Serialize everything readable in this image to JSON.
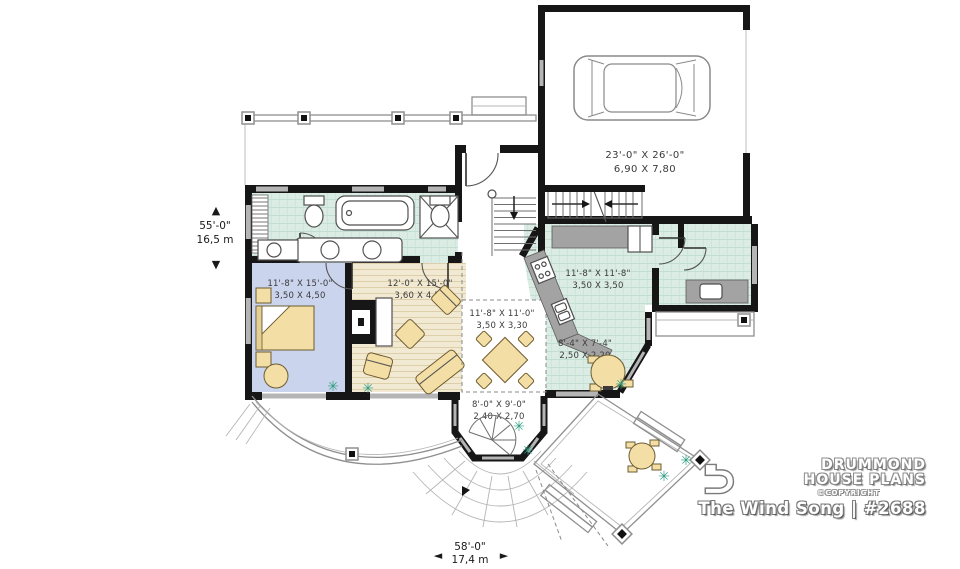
{
  "plan": {
    "title": "The Wind Song | #2688",
    "brand": {
      "line1": "DRUMMOND",
      "line2": "HOUSE PLANS",
      "copyright": "©COPYRIGHT"
    },
    "dimensions": {
      "left": {
        "imperial": "55'-0\"",
        "metric": "16,5 m"
      },
      "bottom": {
        "imperial": "58'-0\"",
        "metric": "17,4 m"
      }
    },
    "rooms": {
      "garage": {
        "imperial": "23'-0\" X 26'-0\"",
        "metric": "6,90 X 7,80"
      },
      "bedroom": {
        "imperial": "11'-8\" X 15'-0\"",
        "metric": "3,50 X 4,50"
      },
      "living": {
        "imperial": "12'-0\" X 15'-0\"",
        "metric": "3,60 X 4,50"
      },
      "dining": {
        "imperial": "11'-8\" X 11'-0\"",
        "metric": "3,50 X 3,30"
      },
      "kitchen": {
        "imperial": "11'-8\" X 11'-8\"",
        "metric": "3,50 X 3,50"
      },
      "nook": {
        "imperial": "8'-4\" X 7'-4\"",
        "metric": "2,50 X 2,20"
      },
      "veranda": {
        "imperial": "8'-0\" X 9'-0\"",
        "metric": "2,40 X 2,70"
      }
    },
    "icons": {
      "plant": "✳",
      "arrow_up": "▲",
      "arrow_down": "▼",
      "arrow_left": "◄",
      "arrow_right": "►"
    },
    "colors": {
      "wall": "#161616",
      "floor_tile": "#daece4",
      "floor_bedroom": "#cbd4ed",
      "floor_wood": "#f2e9d3",
      "furniture": "#f3dfa6",
      "counter": "#a3a3a3",
      "plant": "#2f9e82",
      "window": "#b5b5b5"
    }
  }
}
